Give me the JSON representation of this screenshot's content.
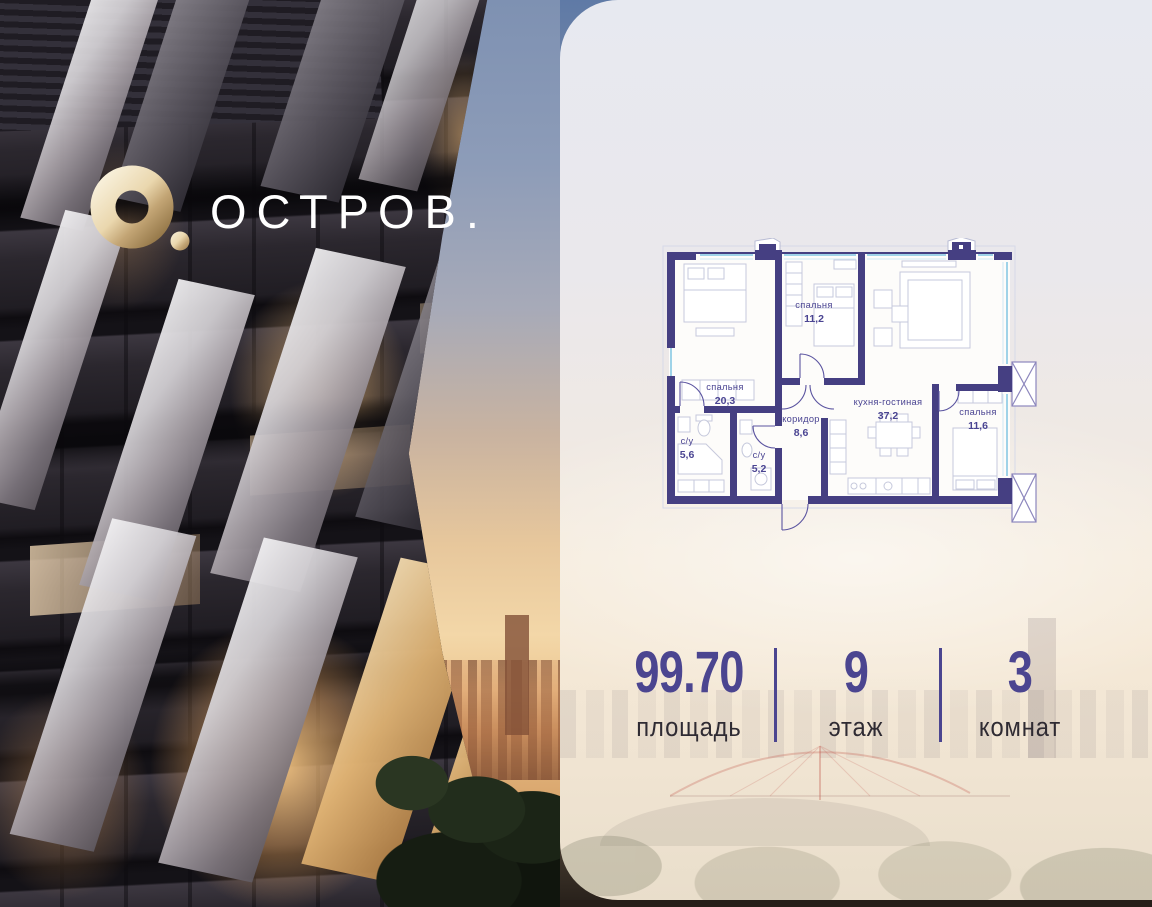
{
  "logo": {
    "brand": "ОСТРОВ."
  },
  "plan": {
    "rooms": [
      {
        "name": "спальня",
        "area": "20,3"
      },
      {
        "name": "спальня",
        "area": "11,2"
      },
      {
        "name": "кухня-гостиная",
        "area": "37,2"
      },
      {
        "name": "спальня",
        "area": "11,6"
      },
      {
        "name": "коридор",
        "area": "8,6"
      },
      {
        "name": "с/у",
        "area": "5,6"
      },
      {
        "name": "с/у",
        "area": "5,2"
      }
    ]
  },
  "stats": [
    {
      "value": "99.70",
      "label": "площадь"
    },
    {
      "value": "9",
      "label": "этаж"
    },
    {
      "value": "3",
      "label": "комнат"
    }
  ],
  "colors": {
    "accent_indigo": "#4b4590",
    "plan_wall": "#453f82",
    "plan_window": "#9fd3e8",
    "logo_gold": "#e3cda0",
    "label_dark": "#2f2b33"
  }
}
